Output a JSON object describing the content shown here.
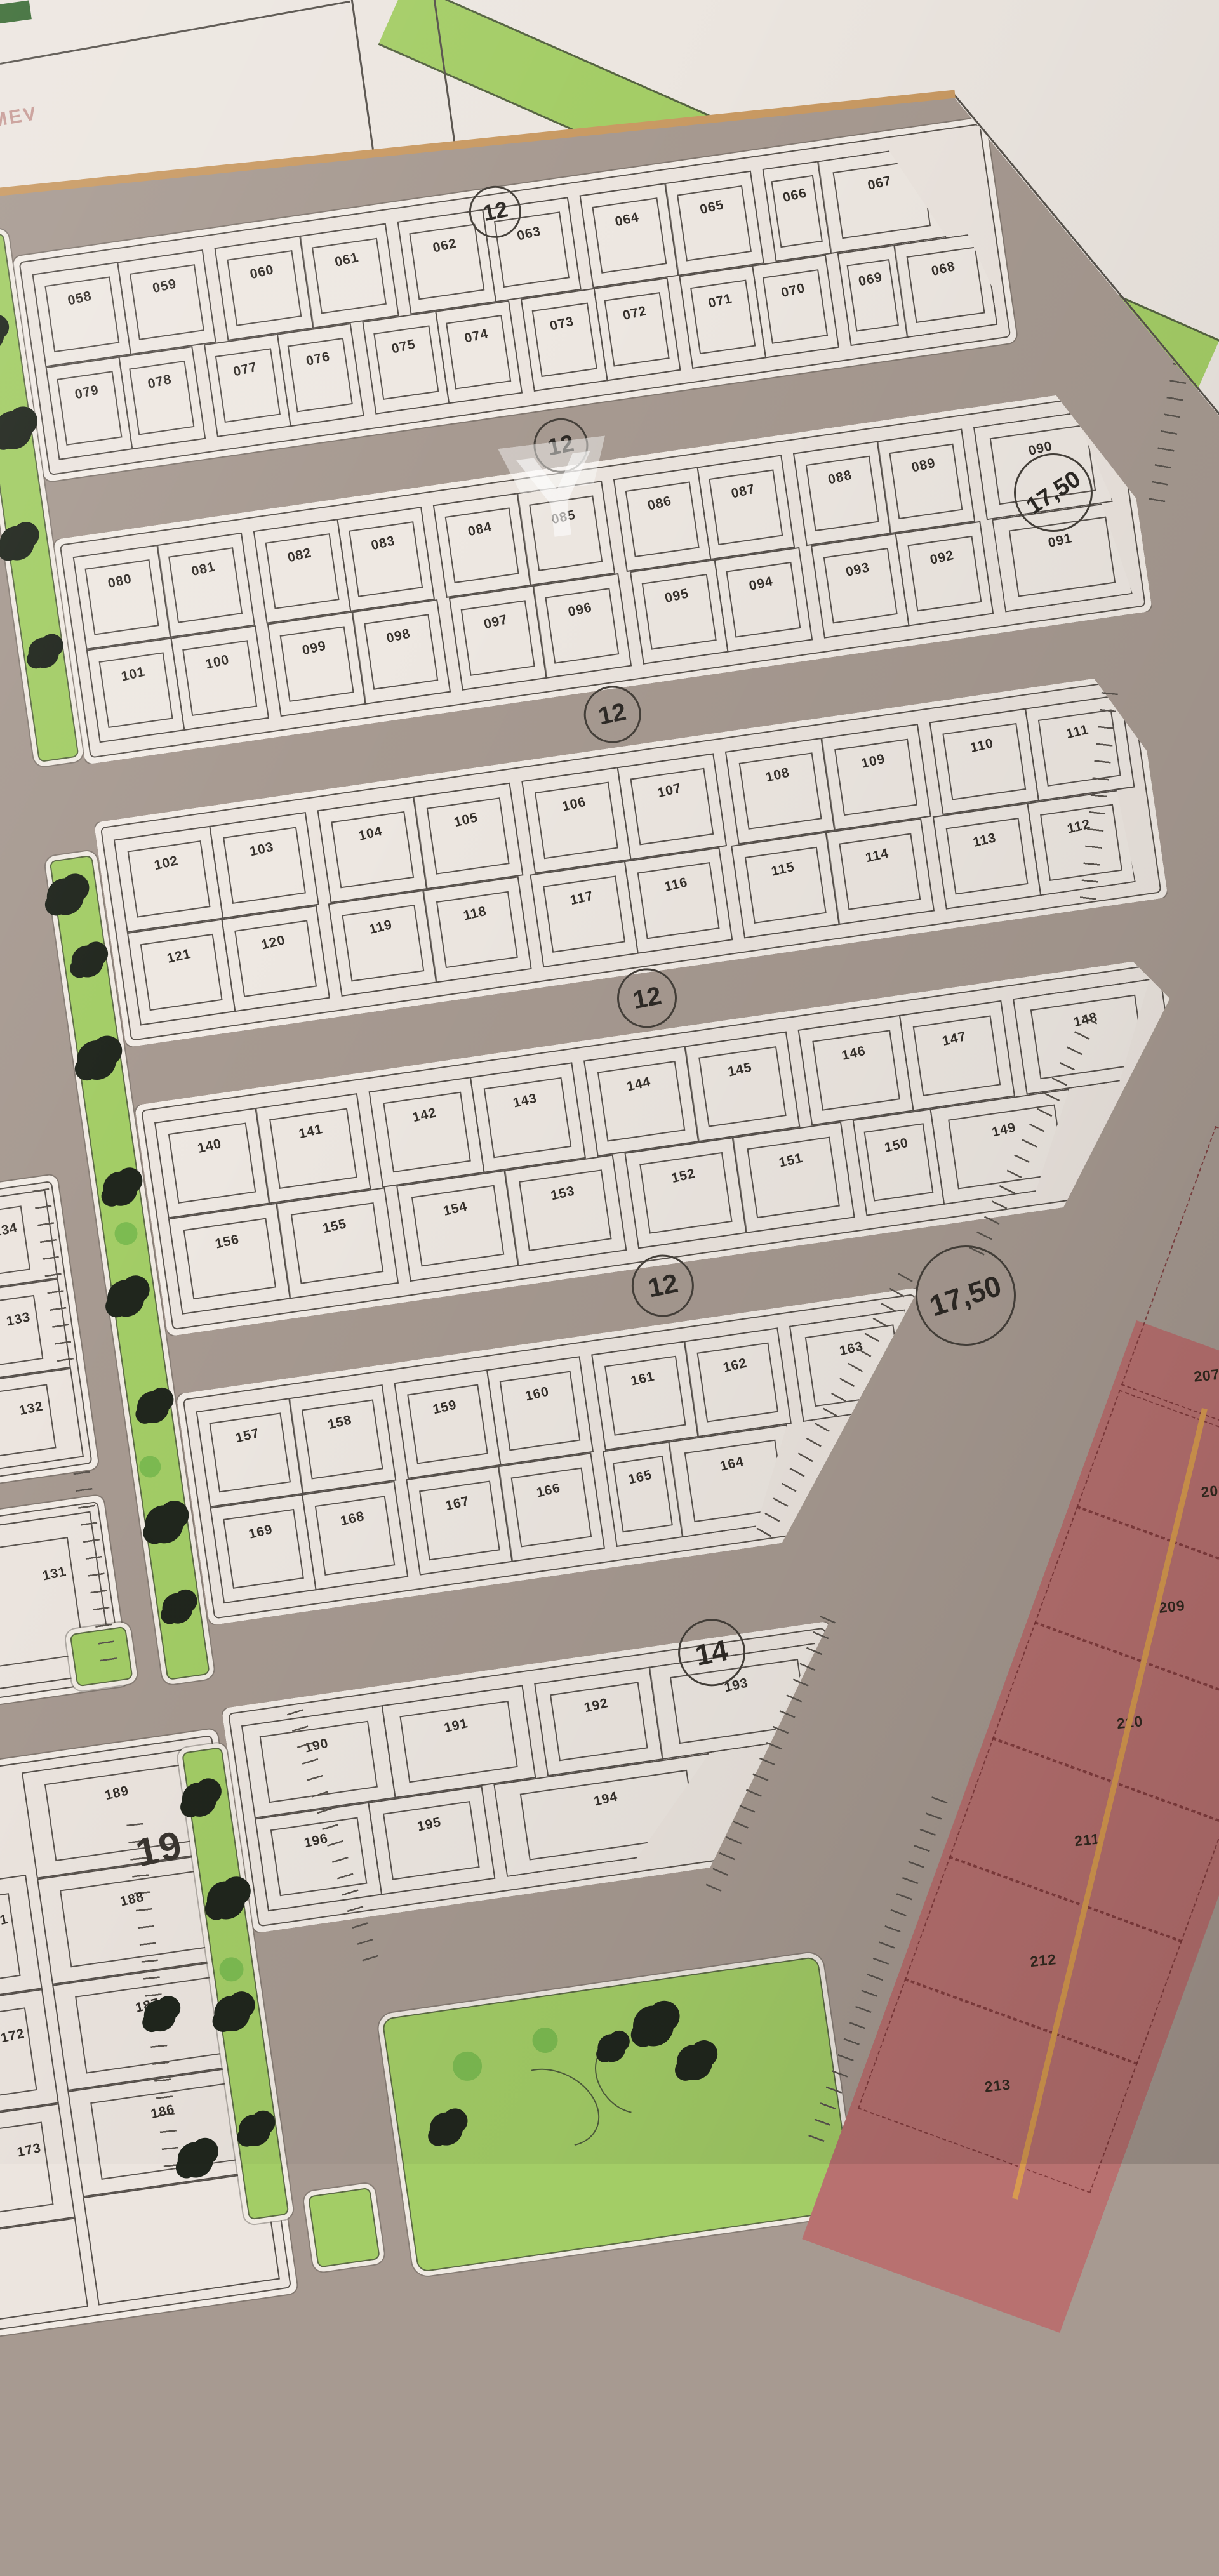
{
  "top_area": {
    "corner_text": "MEV"
  },
  "watermark_letter": "Y",
  "road_labels": {
    "circles": [
      "12",
      "12",
      "12",
      "12",
      "12",
      "14"
    ],
    "width_labels": [
      "17,50",
      "17,50"
    ],
    "street_number": "19"
  },
  "blocks": [
    {
      "name": "block-1",
      "rows": [
        [
          "058",
          "059",
          "060",
          "061",
          "062",
          "063",
          "064",
          "065",
          "066",
          "067"
        ],
        [
          "079",
          "078",
          "077",
          "076",
          "075",
          "074",
          "073",
          "072",
          "071",
          "070",
          "069",
          "068"
        ]
      ]
    },
    {
      "name": "block-2",
      "rows": [
        [
          "080",
          "081",
          "082",
          "083",
          "084",
          "085",
          "086",
          "087",
          "088",
          "089",
          "090"
        ],
        [
          "101",
          "100",
          "099",
          "098",
          "097",
          "096",
          "095",
          "094",
          "093",
          "092",
          "091"
        ]
      ]
    },
    {
      "name": "block-3",
      "rows": [
        [
          "102",
          "103",
          "104",
          "105",
          "106",
          "107",
          "108",
          "109",
          "110",
          "111"
        ],
        [
          "121",
          "120",
          "119",
          "118",
          "117",
          "116",
          "115",
          "114",
          "113",
          "112"
        ]
      ]
    },
    {
      "name": "block-4",
      "rows": [
        [
          "140",
          "141",
          "142",
          "143",
          "144",
          "145",
          "146",
          "147",
          "148"
        ],
        [
          "156",
          "155",
          "154",
          "153",
          "152",
          "151",
          "150",
          "149"
        ]
      ]
    },
    {
      "name": "block-5",
      "rows": [
        [
          "157",
          "158",
          "159",
          "160",
          "161",
          "162",
          "163"
        ],
        [
          "169",
          "168",
          "167",
          "166",
          "165",
          "164"
        ]
      ]
    },
    {
      "name": "block-6",
      "rows": [
        [
          "190",
          "191",
          "192",
          "193"
        ],
        [
          "196",
          "195",
          "194"
        ]
      ]
    }
  ],
  "left_column_plots": [
    "134",
    "133",
    "132",
    "131"
  ],
  "left_block": {
    "left_col": [
      "171",
      "172",
      "173"
    ],
    "right_col": [
      "189",
      "188",
      "187",
      "186"
    ]
  },
  "red_zone_plots": [
    "207",
    "208",
    "209",
    "210",
    "211",
    "212",
    "213"
  ],
  "colors": {
    "road": "#a79a91",
    "block_fill": "#ece5df",
    "sidewalk": "#f2ece6",
    "line": "#56504b",
    "green": "#a3cd66",
    "tree": "#20261d",
    "red_zone": "#b87170",
    "red_line": "#7a3436",
    "orange_edge": "#d89a50"
  }
}
